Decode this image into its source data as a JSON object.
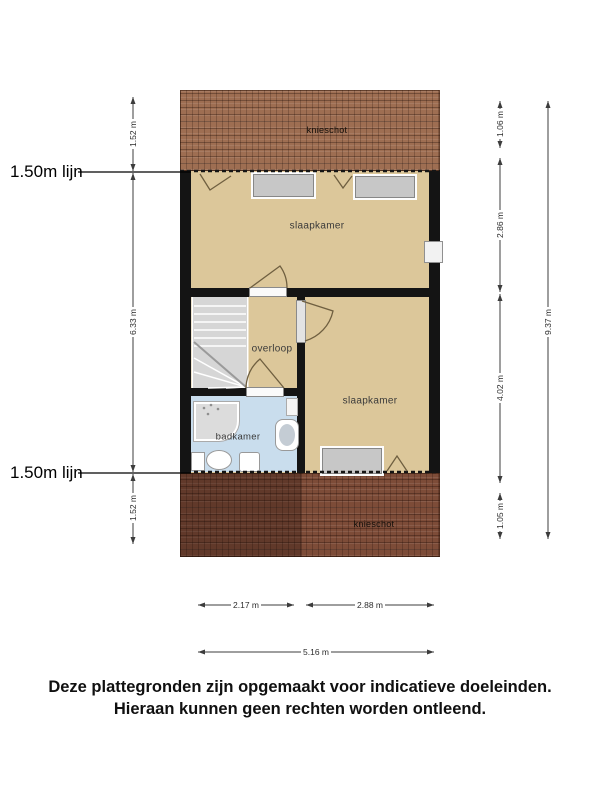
{
  "floorplan": {
    "rooms": {
      "slaapkamer_top": "slaapkamer",
      "slaapkamer_right": "slaapkamer",
      "overloop": "overloop",
      "badkamer": "badkamer"
    },
    "roof": {
      "top_label": "knieschot",
      "bottom_label": "knieschot"
    },
    "height_lines": {
      "top": "1.50m lijn",
      "bottom": "1.50m lijn"
    },
    "dimensions": {
      "left_top": "1.52 m",
      "left_middle": "6.33 m",
      "left_bottom": "1.52 m",
      "right_seg1": "1.06 m",
      "right_seg2": "2.86 m",
      "right_seg3": "4.02 m",
      "right_seg4": "1.05 m",
      "right_total": "9.37 m",
      "bottom_seg1": "2.17 m",
      "bottom_seg2": "2.88 m",
      "bottom_total": "5.16 m"
    },
    "colors": {
      "floor": "#dcc79a",
      "bathroom": "#c9dded",
      "roof_top": "#9e6e52",
      "roof_bottom": "#7d4c38",
      "wall": "#141414"
    }
  },
  "disclaimer": {
    "line1": "Deze plattegronden zijn opgemaakt voor indicatieve doeleinden.",
    "line2": "Hieraan kunnen geen rechten worden ontleend."
  }
}
